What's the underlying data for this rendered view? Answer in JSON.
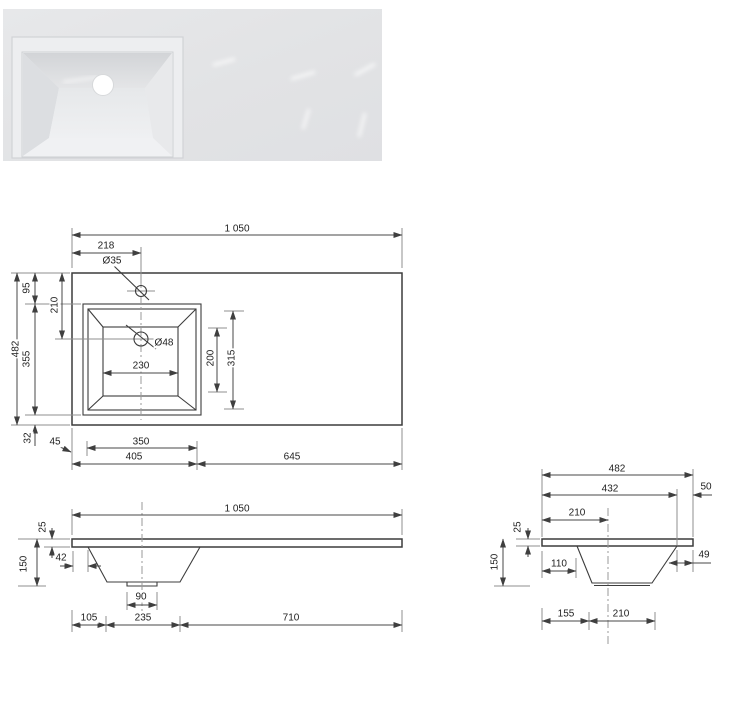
{
  "title": "Washbasin technical dimension drawing",
  "colors": {
    "line": "#3c3c3c",
    "text": "#222222",
    "photo_bg": "#e4e5e7",
    "drain": "#ffffff"
  },
  "photo": {
    "name": "white rectangular washbasin countertop, basin left, drain hole visible"
  },
  "plan": {
    "total_width": "1 050",
    "faucet_offset_x": "218",
    "faucet_hole_diameter": "Ø35",
    "total_depth": "482",
    "edge_to_basin_top": "95",
    "faucet_center_depth": "210",
    "basin_outer_depth": "355",
    "basin_to_edge_bottom": "32",
    "left_edge_to_basin": "45",
    "basin_inner_width": "230",
    "drain_diameter": "Ø48",
    "basin_inner_depth": "200",
    "basin_opening_depth": "315",
    "basin_outer_width": "350",
    "left_section_width": "405",
    "right_section_width": "645"
  },
  "front": {
    "total_width": "1 050",
    "top_thickness": "25",
    "total_height": "150",
    "edge_to_basin_wall": "42",
    "drain_boss_width": "90",
    "left_offset": "105",
    "basin_bottom_width": "235",
    "right_offset": "710"
  },
  "side": {
    "total_depth": "482",
    "front_section": "432",
    "back_overhang": "50",
    "front_to_center": "210",
    "top_thickness": "25",
    "total_height": "150",
    "edge_to_basin_wall": "110",
    "wall_to_back_edge": "49",
    "front_offset": "155",
    "basin_bottom_depth": "210"
  }
}
